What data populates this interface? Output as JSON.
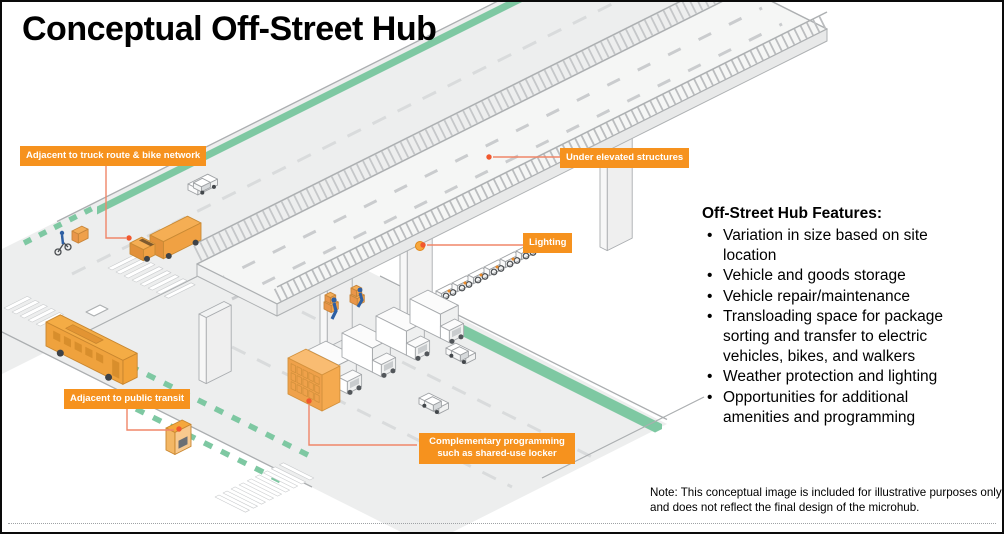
{
  "slide": {
    "title": "Conceptual Off-Street Hub"
  },
  "callouts": [
    {
      "id": "truck-route",
      "text": "Adjacent to truck route & bike network"
    },
    {
      "id": "elevated",
      "text": "Under elevated structures"
    },
    {
      "id": "lighting",
      "text": "Lighting"
    },
    {
      "id": "transit",
      "text": "Adjacent to public transit"
    },
    {
      "id": "programming",
      "text": "Complementary programming such as shared-use locker"
    }
  ],
  "features": {
    "heading": "Off-Street Hub Features:",
    "items": [
      "Variation in size based on site location",
      "Vehicle and goods storage",
      "Vehicle repair/maintenance",
      "Transloading space for package sorting and transfer to electric vehicles, bikes, and walkers",
      "Weather protection and lighting",
      "Opportunities for additional amenities and programming"
    ]
  },
  "note": "Note: This conceptual image is included for illustrative purposes only and does not reflect the final design of the microhub.",
  "colors": {
    "callout_bg": "#F6921E",
    "leader_line": "#F08568",
    "leader_dot": "#F1582E",
    "bike_lane_green": "#7EC8A2",
    "vehicle_orange": "#F2A83E",
    "road_gray": "#EDEEEE"
  }
}
